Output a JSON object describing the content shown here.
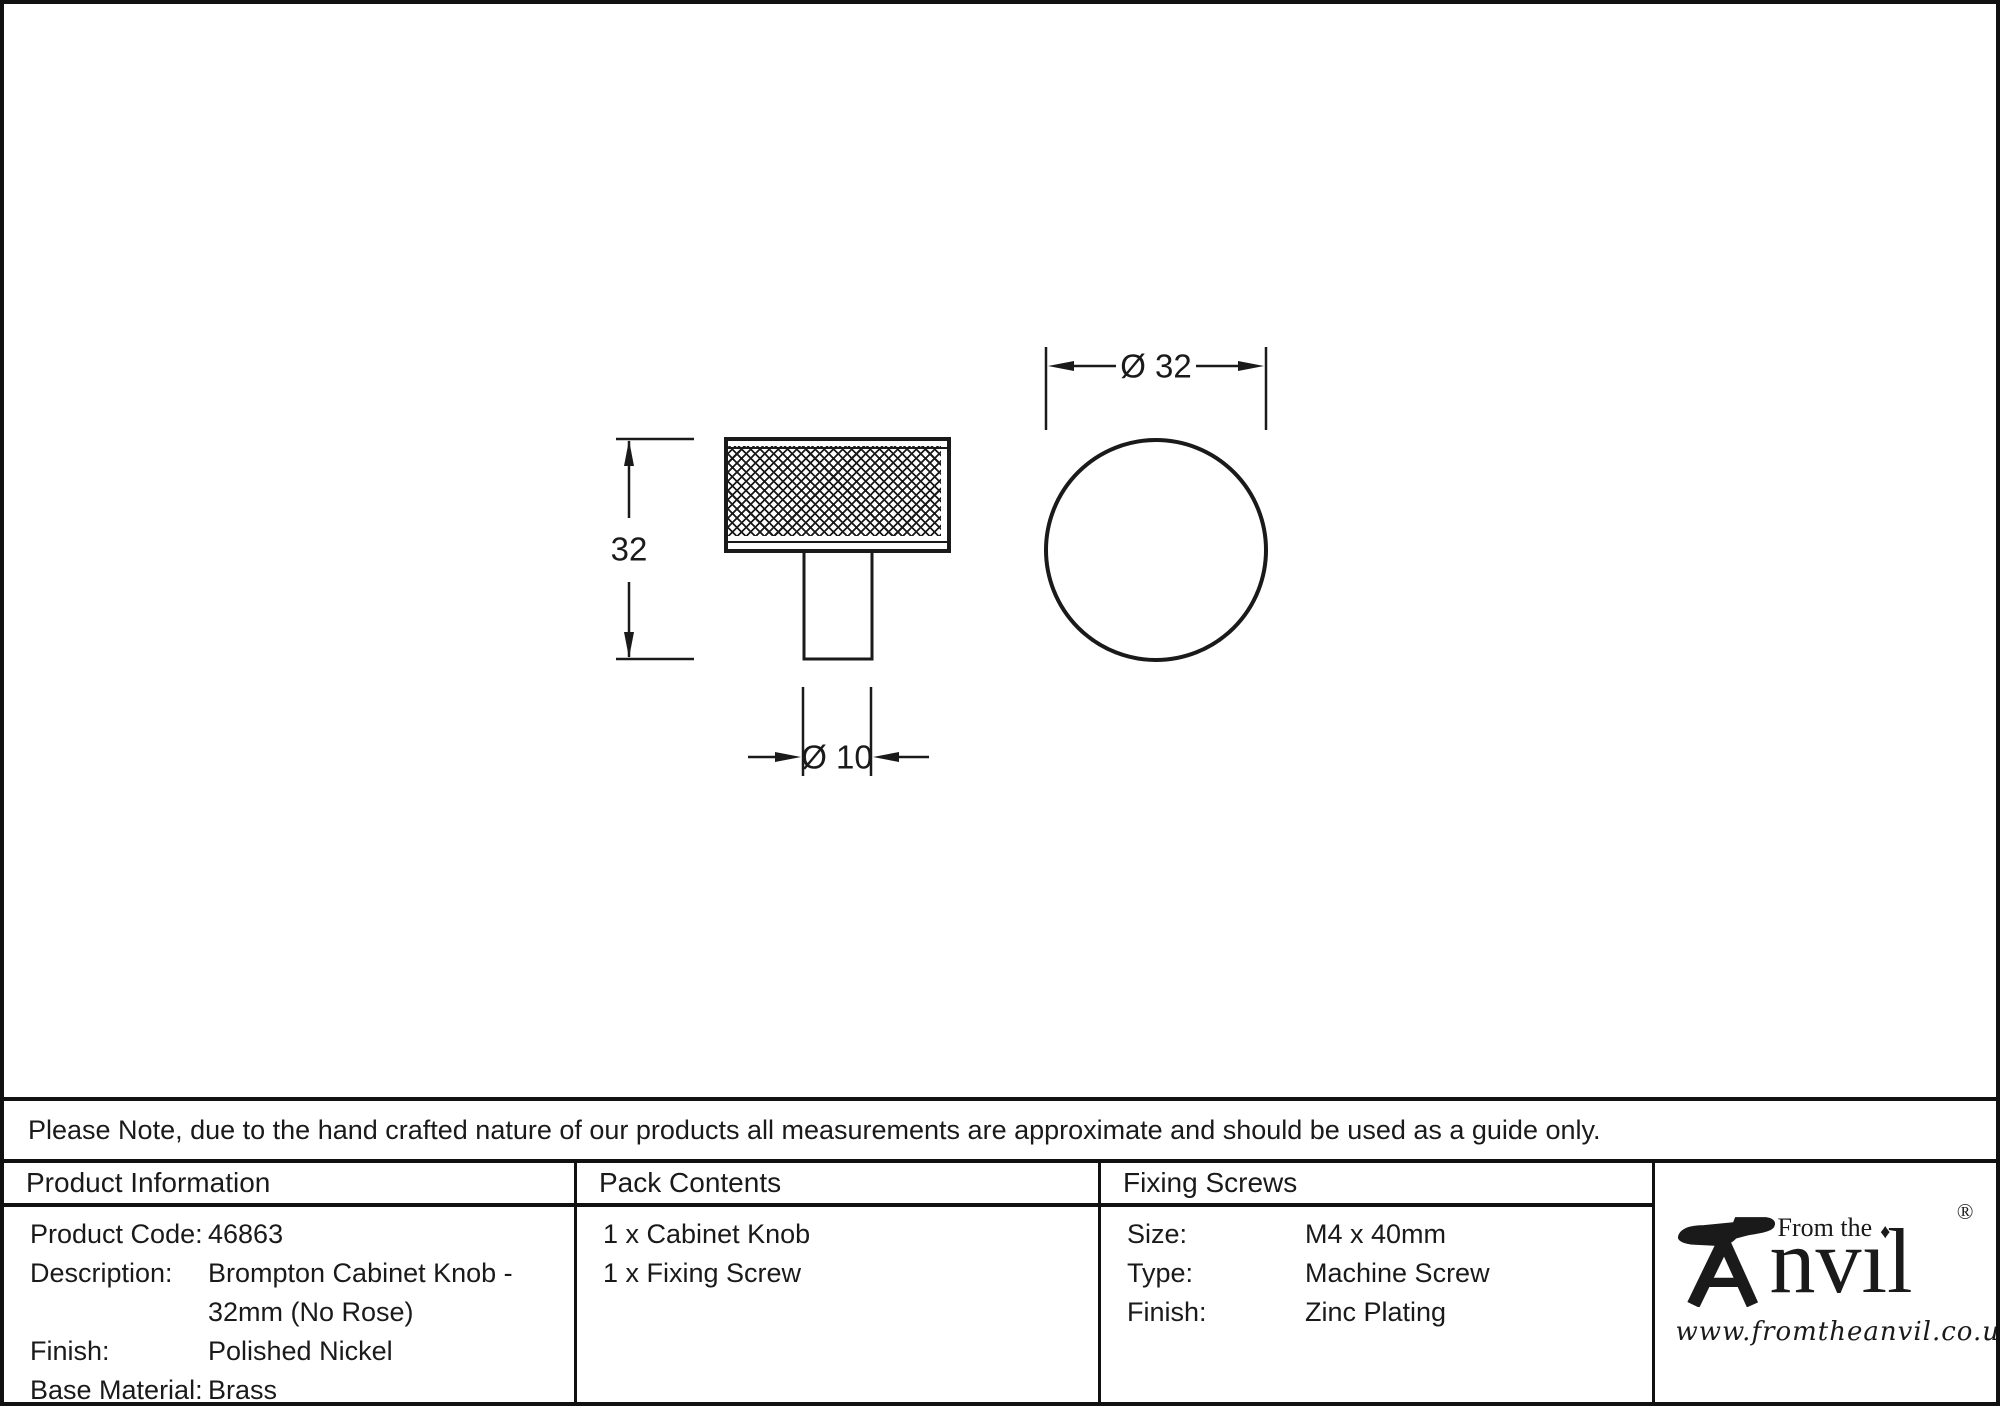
{
  "colors": {
    "ink": "#1a1a1a",
    "border": "#111111",
    "background": "#ffffff"
  },
  "drawing": {
    "side_view": {
      "height_label": "32",
      "stem_label": "Ø 10"
    },
    "front_view": {
      "diameter_label": "Ø 32"
    }
  },
  "note": "Please Note, due to the hand crafted nature of our products all measurements are approximate and should be used as a guide only.",
  "product_information": {
    "header": "Product Information",
    "rows": [
      {
        "label": "Product Code:",
        "value": "46863"
      },
      {
        "label": "Description:",
        "value": "Brompton Cabinet Knob - 32mm (No Rose)"
      },
      {
        "label": "Finish:",
        "value": "Polished Nickel"
      },
      {
        "label": "Base Material:",
        "value": "Brass"
      }
    ]
  },
  "pack_contents": {
    "header": "Pack Contents",
    "items": [
      "1 x Cabinet Knob",
      "1 x Fixing Screw"
    ]
  },
  "fixing_screws": {
    "header": "Fixing Screws",
    "rows": [
      {
        "label": "Size:",
        "value": "M4 x 40mm"
      },
      {
        "label": "Type:",
        "value": "Machine Screw"
      },
      {
        "label": "Finish:",
        "value": "Zinc Plating"
      }
    ]
  },
  "logo": {
    "brand": "Anvil",
    "name_rest": "nvıl",
    "tagline": "From the",
    "diamond": "♦",
    "registered": "®",
    "url": "www.fromtheanvil.co.uk"
  }
}
